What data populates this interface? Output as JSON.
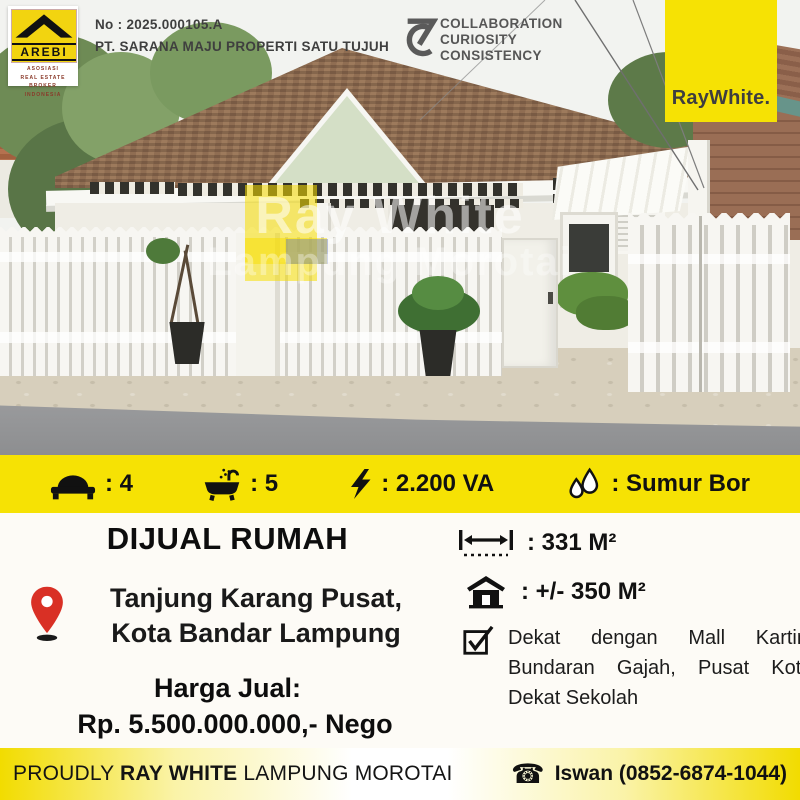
{
  "header": {
    "listing_no": "No : 2025.000105.A",
    "company": "PT. SARANA MAJU PROPERTI SATU TUJUH",
    "arebi": {
      "name": "AREBI",
      "lines": [
        "ASOSIASI",
        "REAL ESTATE BROKER",
        "INDONESIA"
      ]
    },
    "values": {
      "lines": [
        "COLLABORATION",
        "CURIOSITY",
        "CONSISTENCY"
      ]
    },
    "brand": "RayWhite."
  },
  "photo": {
    "watermark": {
      "line1": "Ray White",
      "line2": "Lampung Morotai"
    }
  },
  "features": {
    "bedrooms": ": 4",
    "bathrooms": ": 5",
    "electricity": ": 2.200 VA",
    "water": ": Sumur Bor"
  },
  "listing": {
    "title": "DIJUAL RUMAH",
    "location_line1": "Tanjung Karang Pusat,",
    "location_line2": "Kota Bandar Lampung",
    "price_label": "Harga Jual:",
    "price_value": "Rp. 5.500.000.000,- Nego",
    "land_area": ": 331 M²",
    "building_area": ": +/- 350 M²",
    "nearby": "Dekat dengan Mall Kartini, Bundaran Gajah, Pusat Kota, Dekat Sekolah"
  },
  "footer": {
    "prefix": "PROUDLY",
    "brand": "RAY WHITE",
    "office": "LAMPUNG MOROTAI",
    "contact": "Iswan (0852-6874-1044)"
  },
  "icons": {
    "bed": "svg-bed",
    "bath": "svg-bathtub",
    "electricity": "svg-lightning-bolt",
    "water": "svg-water-drops",
    "land_width": "svg-width-measure",
    "building": "svg-house",
    "nearby_check": "svg-checked-box",
    "location_pin": "svg-map-pin",
    "phone": "☎",
    "values_mark": "svg-7c-mark",
    "arebi_roof": "svg-roof-chevron"
  },
  "colors": {
    "brand_yellow": "#F6E204",
    "pin_red": "#D93025",
    "text_dark": "#141414",
    "logo_text": "#3E3E40"
  }
}
